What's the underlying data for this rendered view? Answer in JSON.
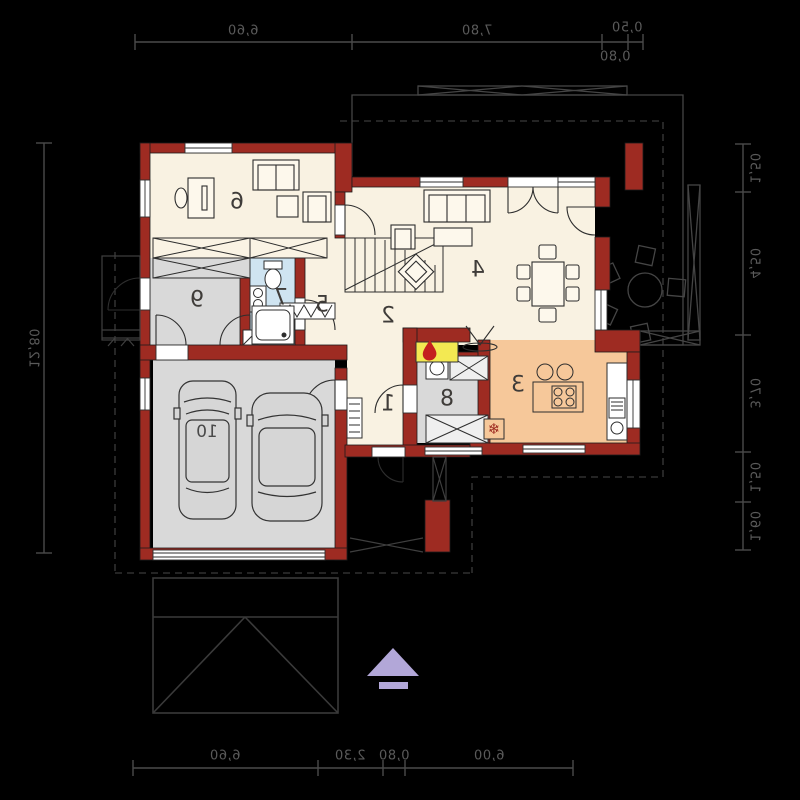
{
  "plan_type": "house-ground-floor-plan-mirrored",
  "rooms": {
    "r1": "1",
    "r2": "2",
    "r3": "3",
    "r4": "4",
    "r5": "5",
    "r6": "6",
    "r7": "7",
    "r8": "8",
    "r9": "9",
    "r10": "10"
  },
  "dimensions": {
    "top": [
      "6,60",
      "7,80",
      "0,50",
      "0,80"
    ],
    "bottom": [
      "6,60",
      "2,30",
      "0,80",
      "6,00"
    ],
    "left": [
      "12,80"
    ],
    "right": [
      "1,50",
      "4,50",
      "3,70",
      "1,50",
      "1,60"
    ]
  },
  "icons": {
    "fridge_snowflake": "❄"
  },
  "colors": {
    "background": "#000000",
    "wall_red": "#9e2b22",
    "floor_cream": "#f9f2e2",
    "floor_kitchen_orange": "#f6c89a",
    "floor_gray": "#d9d9d9",
    "floor_bath_blue": "#cfe4f1",
    "fireplace_yellow": "#f3e952",
    "flame_red": "#c4201f",
    "entrance_arrow_purple": "#b2a7d8",
    "dimension_gray": "#5a5a5a"
  }
}
